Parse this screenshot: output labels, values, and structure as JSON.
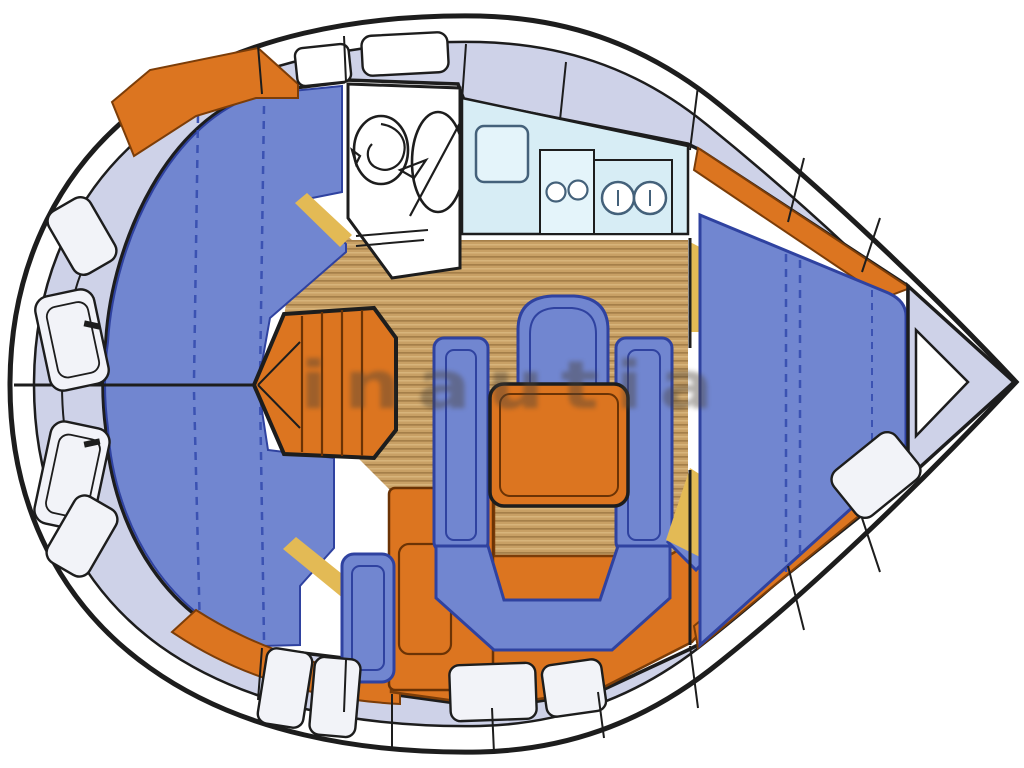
{
  "watermark": {
    "text": "inautia"
  },
  "colors": {
    "hull_line": "#1d1d1d",
    "deck_fill": "#ced2e8",
    "hatch_fill": "#f2f3f8",
    "cushion": "#7186d0",
    "cushion_line": "#2f42a0",
    "dash_line": "#3b52b2",
    "orange": "#dc7520",
    "orange_line": "#7c3d08",
    "orange_step": "#6b3305",
    "wood": "#c8a065",
    "wood_stripe_dark": "#7a5628",
    "wood_stripe_light": "#ebcd96",
    "counter": "#d7edf5",
    "counter_inner": "#e4f4fa",
    "counter_line": "#44617a",
    "white": "#ffffff",
    "yellow": "#e3ba55",
    "watermark_color": "#4a4238"
  },
  "parts": [
    {
      "id": "hull",
      "label": "Hull outline"
    },
    {
      "id": "side-deck",
      "label": "Side deck"
    },
    {
      "id": "stern-seats",
      "label": "Stern bench lockers"
    },
    {
      "id": "cockpit",
      "label": "Cockpit cushions"
    },
    {
      "id": "companionway",
      "label": "Companionway steps"
    },
    {
      "id": "saloon-floor",
      "label": "Saloon floor"
    },
    {
      "id": "head",
      "label": "Head: toilet and washbasin"
    },
    {
      "id": "galley",
      "label": "Galley: icebox, stove, twin sinks"
    },
    {
      "id": "nav-station",
      "label": "Nav seat and chart table"
    },
    {
      "id": "dinette",
      "label": "Saloon dinette and table"
    },
    {
      "id": "v-berth",
      "label": "Forward V-berth cabin"
    },
    {
      "id": "anchor-locker",
      "label": "Anchor locker"
    },
    {
      "id": "watermark",
      "label": "Watermark"
    }
  ]
}
